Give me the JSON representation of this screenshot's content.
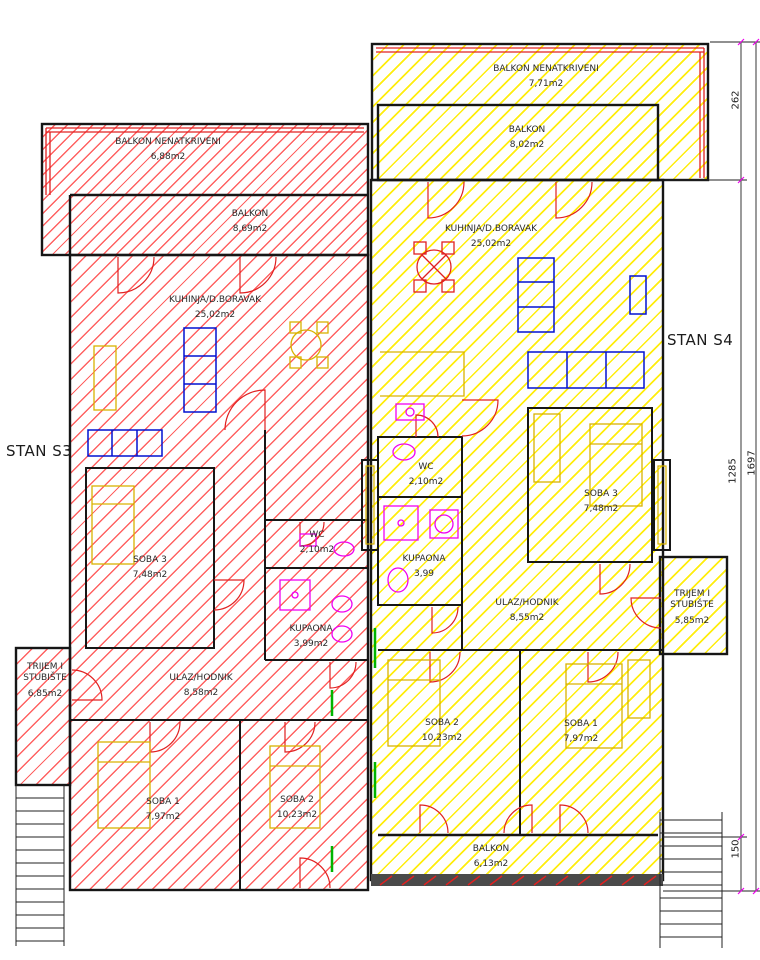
{
  "drawing": {
    "type": "architectural-floor-plan",
    "colors": {
      "s3_hatch": "#ff5050",
      "s4_hatch": "#ffec00",
      "walls": "#161616",
      "doors_red": "#e02020",
      "furniture_blue": "#0010d0",
      "furniture_yellow": "#d9b200",
      "fixtures_magenta": "#f000f0",
      "accents_green": "#00b400"
    }
  },
  "apartments": {
    "s3": {
      "label": "STAN S3",
      "rooms": {
        "balkon_nenatkriveni": {
          "name": "BALKON NENATKRIVENI",
          "area": "6,88m2"
        },
        "balkon": {
          "name": "BALKON",
          "area": "8,69m2"
        },
        "kuhinja": {
          "name": "KUHINJA/D.BORAVAK",
          "area": "25,02m2"
        },
        "soba3": {
          "name": "SOBA 3",
          "area": "7,48m2"
        },
        "wc": {
          "name": "WC",
          "area": "2,10m2"
        },
        "kupaona": {
          "name": "KUPAONA",
          "area": "3,99m2"
        },
        "ulaz": {
          "name": "ULAZ/HODNIK",
          "area": "8,58m2"
        },
        "trijem": {
          "name": "TRIJEM I STUBIŠTE",
          "area": "6,85m2"
        },
        "soba1": {
          "name": "SOBA 1",
          "area": "7,97m2"
        },
        "soba2": {
          "name": "SOBA 2",
          "area": "10,23m2"
        }
      }
    },
    "s4": {
      "label": "STAN S4",
      "rooms": {
        "balkon_nenatkriveni": {
          "name": "BALKON NENATKRIVENI",
          "area": "7,71m2"
        },
        "balkon": {
          "name": "BALKON",
          "area": "8,02m2"
        },
        "kuhinja": {
          "name": "KUHINJA/D.BORAVAK",
          "area": "25,02m2"
        },
        "wc": {
          "name": "WC",
          "area": "2,10m2"
        },
        "kupaona": {
          "name": "KUPAONA",
          "area": "3,99"
        },
        "soba3": {
          "name": "SOBA 3",
          "area": "7,48m2"
        },
        "ulaz": {
          "name": "ULAZ/HODNIK",
          "area": "8,55m2"
        },
        "trijem": {
          "name": "TRIJEM I STUBIŠTE",
          "area": "5,85m2"
        },
        "soba2": {
          "name": "SOBA 2",
          "area": "10,23m2"
        },
        "soba1": {
          "name": "SOBA 1",
          "area": "7,97m2"
        },
        "balkon_donji": {
          "name": "BALKON",
          "area": "6,13m2"
        }
      }
    }
  },
  "dimensions": {
    "d262": "262",
    "d1285": "1285",
    "d150": "150",
    "d1697": "1697"
  }
}
